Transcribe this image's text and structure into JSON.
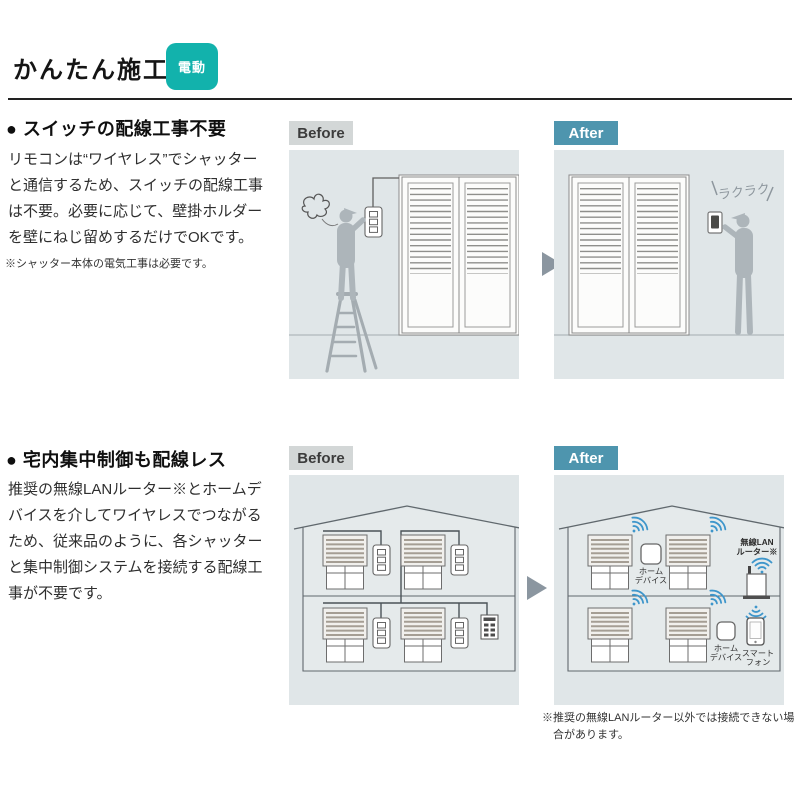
{
  "header": {
    "title": "かんたん施工",
    "badge": "電動"
  },
  "section1": {
    "heading": "● スイッチの配線工事不要",
    "body": "リモコンは“ワイヤレス”でシャッターと通信するため、スイッチの配線工事は不要。必要に応じて、壁掛ホルダーを壁にねじ留めするだけでOKです。",
    "note": "※シャッター本体の電気工事は必要です。",
    "before_label": "Before",
    "after_label": "After",
    "after_callout": "ラクラク"
  },
  "section2": {
    "heading": "● 宅内集中制御も配線レス",
    "body": "推奨の無線LANルーター※とホームデバイスを介してワイヤレスでつながるため、従来品のように、各シャッターと集中制御システムを接続する配線工事が不要です。",
    "before_label": "Before",
    "after_label": "After",
    "router_label_1": "無線LAN",
    "router_label_2": "ルーター※",
    "home_device_label_1": "ホーム",
    "home_device_label_2": "デバイス",
    "smartphone_label_1": "スマート",
    "smartphone_label_2": "フォン",
    "footnote": "※推奨の無線LANルーター以外では接続できない場合があります。"
  },
  "colors": {
    "accent_teal": "#12b2ac",
    "after_blue": "#4e95ae",
    "before_gray": "#d3d7d7",
    "panel_bg": "#e0e6e8",
    "wifi_blue": "#3e96cb"
  }
}
